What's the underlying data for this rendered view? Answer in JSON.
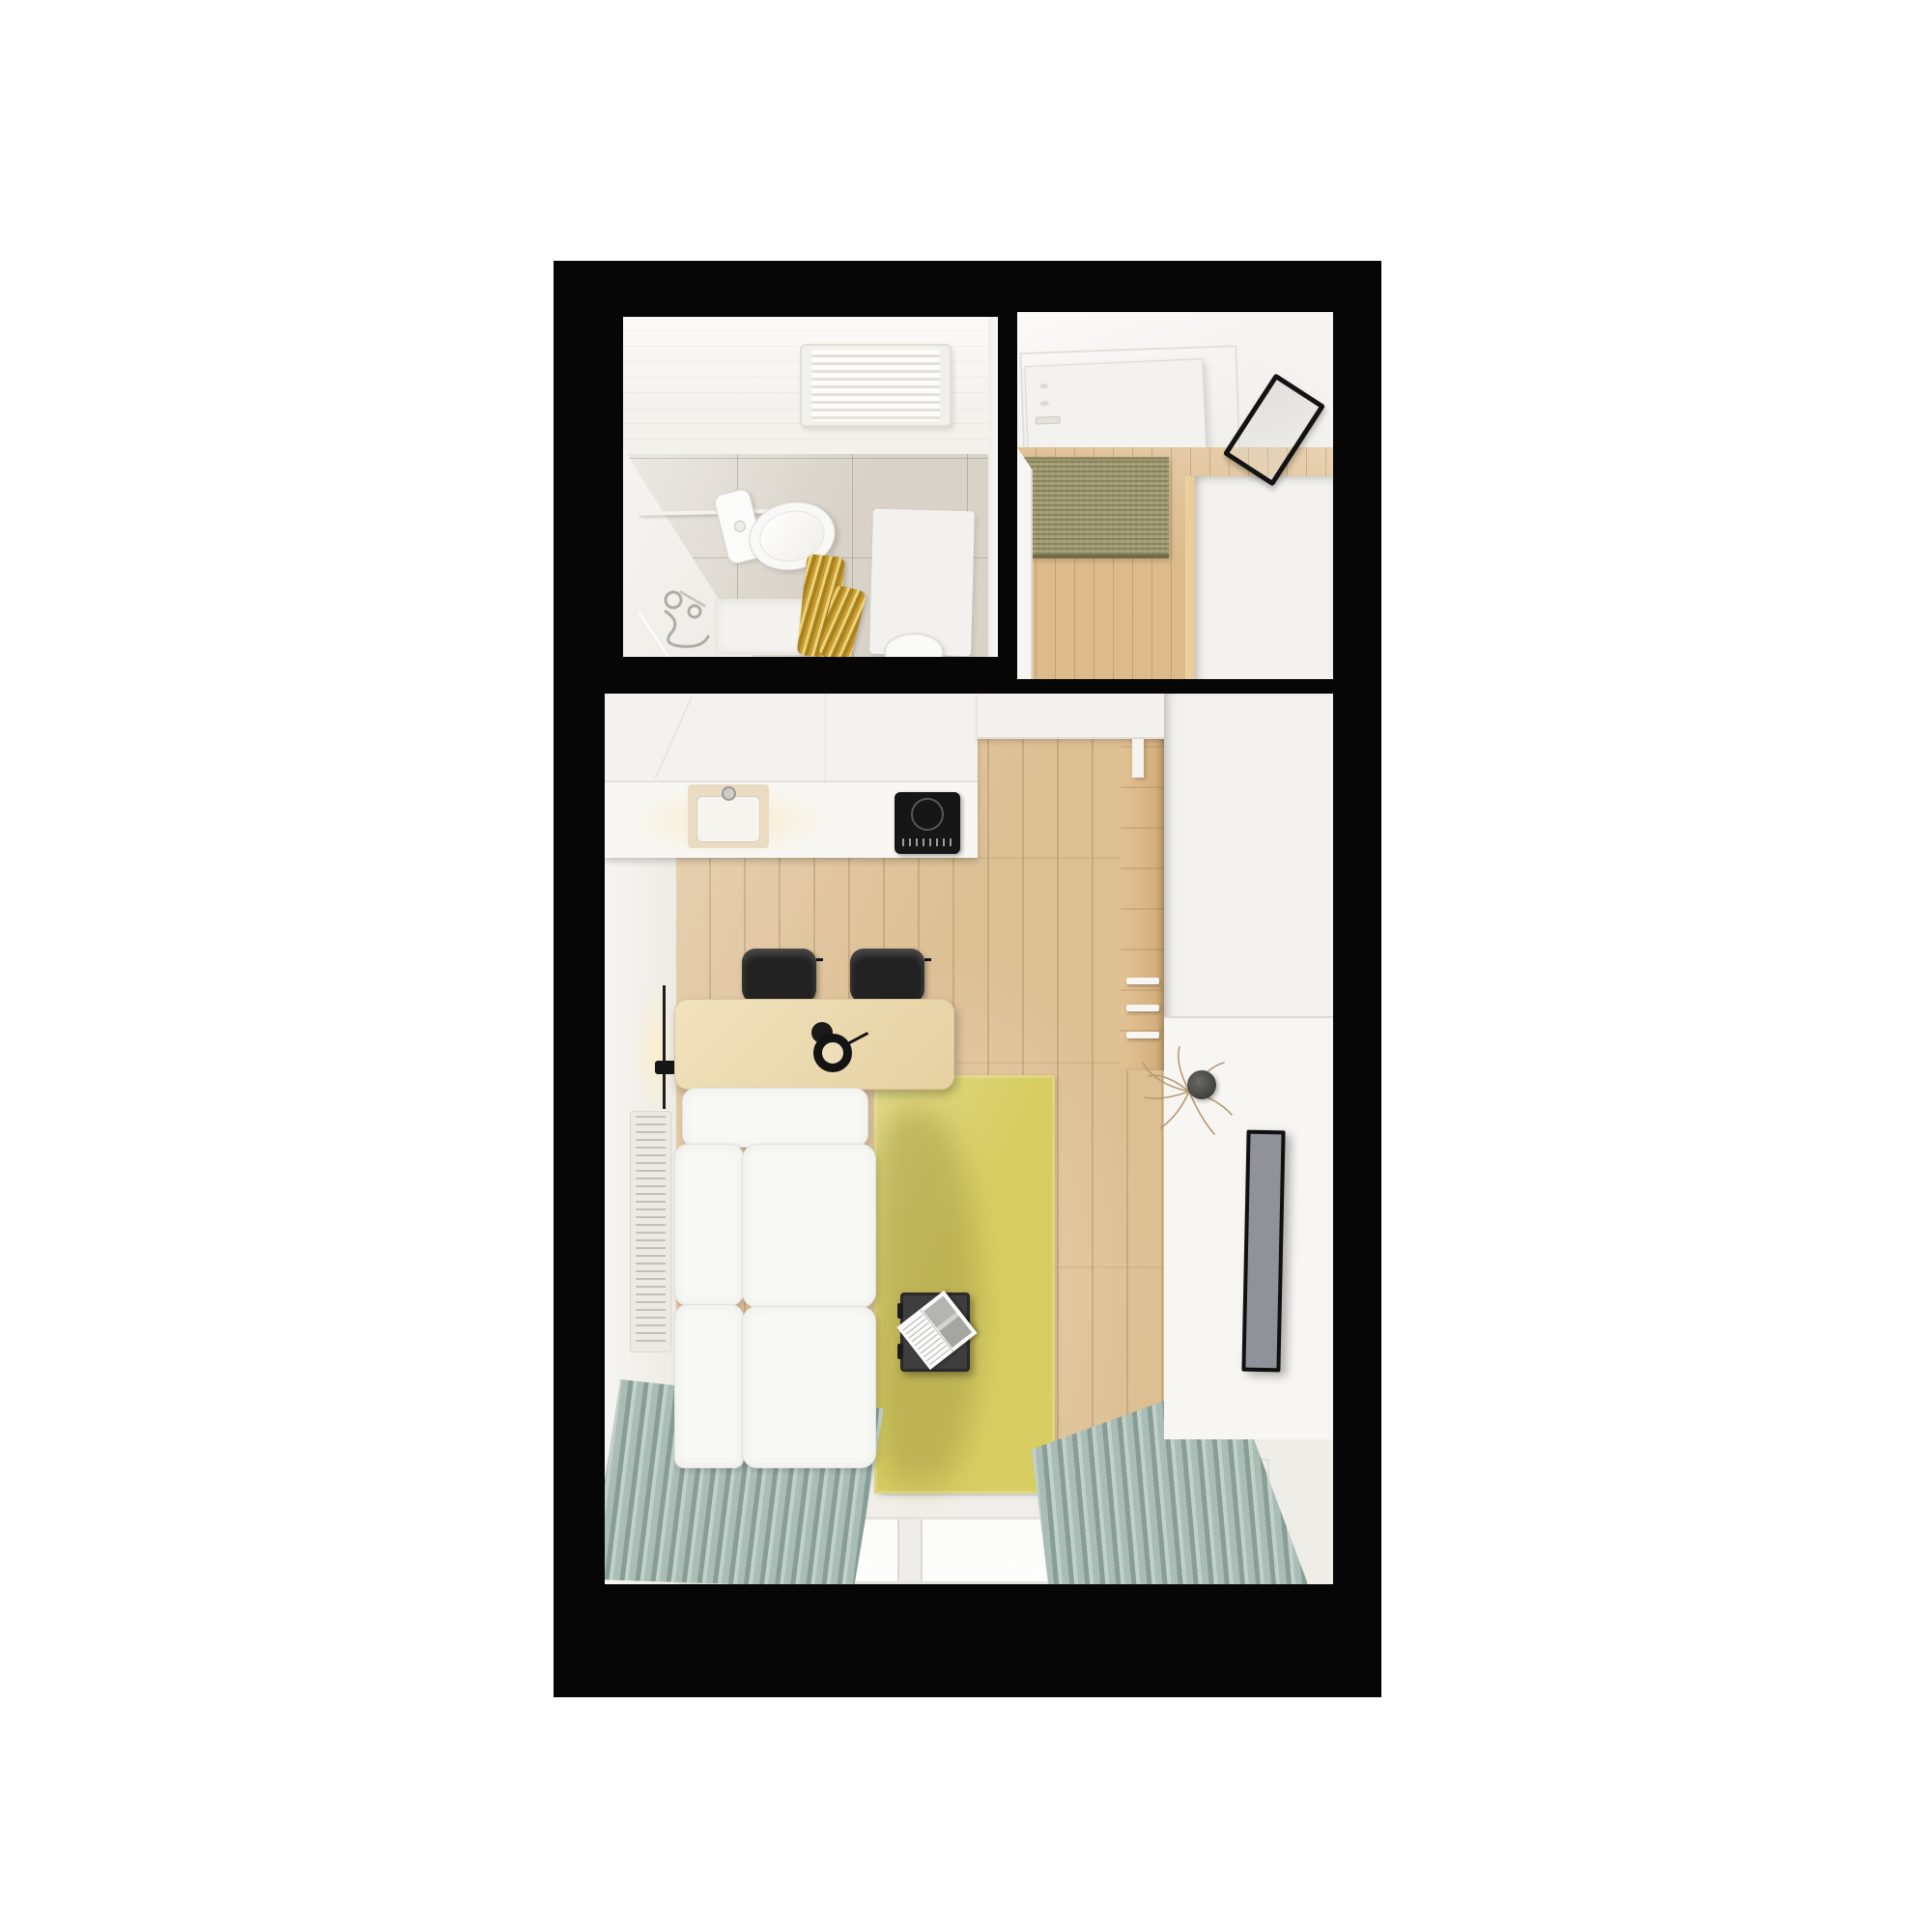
{
  "meta": {
    "title": "Top-down 3D render of a studio apartment floor plan",
    "view": "top-down interior render",
    "rooms_count": "3"
  },
  "palette": {
    "page_bg": "#ffffff",
    "wall_black": "#060606",
    "wall_white": "#f4f2ef",
    "bathroom_floor": "#d8d2c8",
    "wood_floor": "#ddbf94",
    "hall_wood": "#dcba8a",
    "sisal": "#a29c72",
    "sisal_dark": "#8f8a63",
    "rug_yellow": "#d7cd62",
    "rug_shadow": "#a89f4a",
    "curtain_a": "#a9bdb6",
    "curtain_b": "#879d95",
    "curtain_c": "#c2d0ca",
    "table_wood": "#ecd9ae",
    "chair_black": "#222222",
    "sofa_white": "#f8f8f5",
    "hob_black": "#161616",
    "tv_screen": "#8f9298",
    "frame_black": "#131313",
    "gold_a": "#c79b2f",
    "gold_b": "#ecd27a",
    "gold_c": "#a8821f",
    "counter_white": "#f7f6f2",
    "grille_white": "#eceae4",
    "beige_sink": "#e9dcc3"
  },
  "rooms": {
    "bathroom": {
      "label": "Bathroom",
      "items": {
        "towel_radiator": "towel radiator",
        "toilet": "toilet",
        "shower_rail": "shower curtain rail",
        "gold_curtain": "gold shower curtain",
        "shower_mixer": "shower mixer",
        "shower_tray": "shower tray",
        "bath_mat": "bath mat",
        "stool": "round stool"
      }
    },
    "hallway": {
      "label": "Entrance hall",
      "items": {
        "entry_door": "entry door",
        "doormat": "sisal doormat",
        "mirror": "leaning mirror",
        "wardrobe": "wardrobe",
        "open_door": "open interior door"
      }
    },
    "living": {
      "label": "Living room with kitchenette",
      "items": {
        "kitchen": "kitchen counter",
        "sink": "sink",
        "hob": "induction hob",
        "dining_table": "dining table",
        "chair": "dining chair",
        "pendant": "pendant lamp",
        "wall_lamp": "wall lamp",
        "sofa": "corner sofa",
        "rug": "yellow rug",
        "coffee_table": "coffee table with magazine",
        "radiator": "radiator grille",
        "wood_wall": "wood accent wall with shelves",
        "sideboard": "sideboard",
        "vase": "vase with dry branches",
        "tv": "television",
        "window": "window",
        "curtain": "curtain"
      }
    }
  }
}
